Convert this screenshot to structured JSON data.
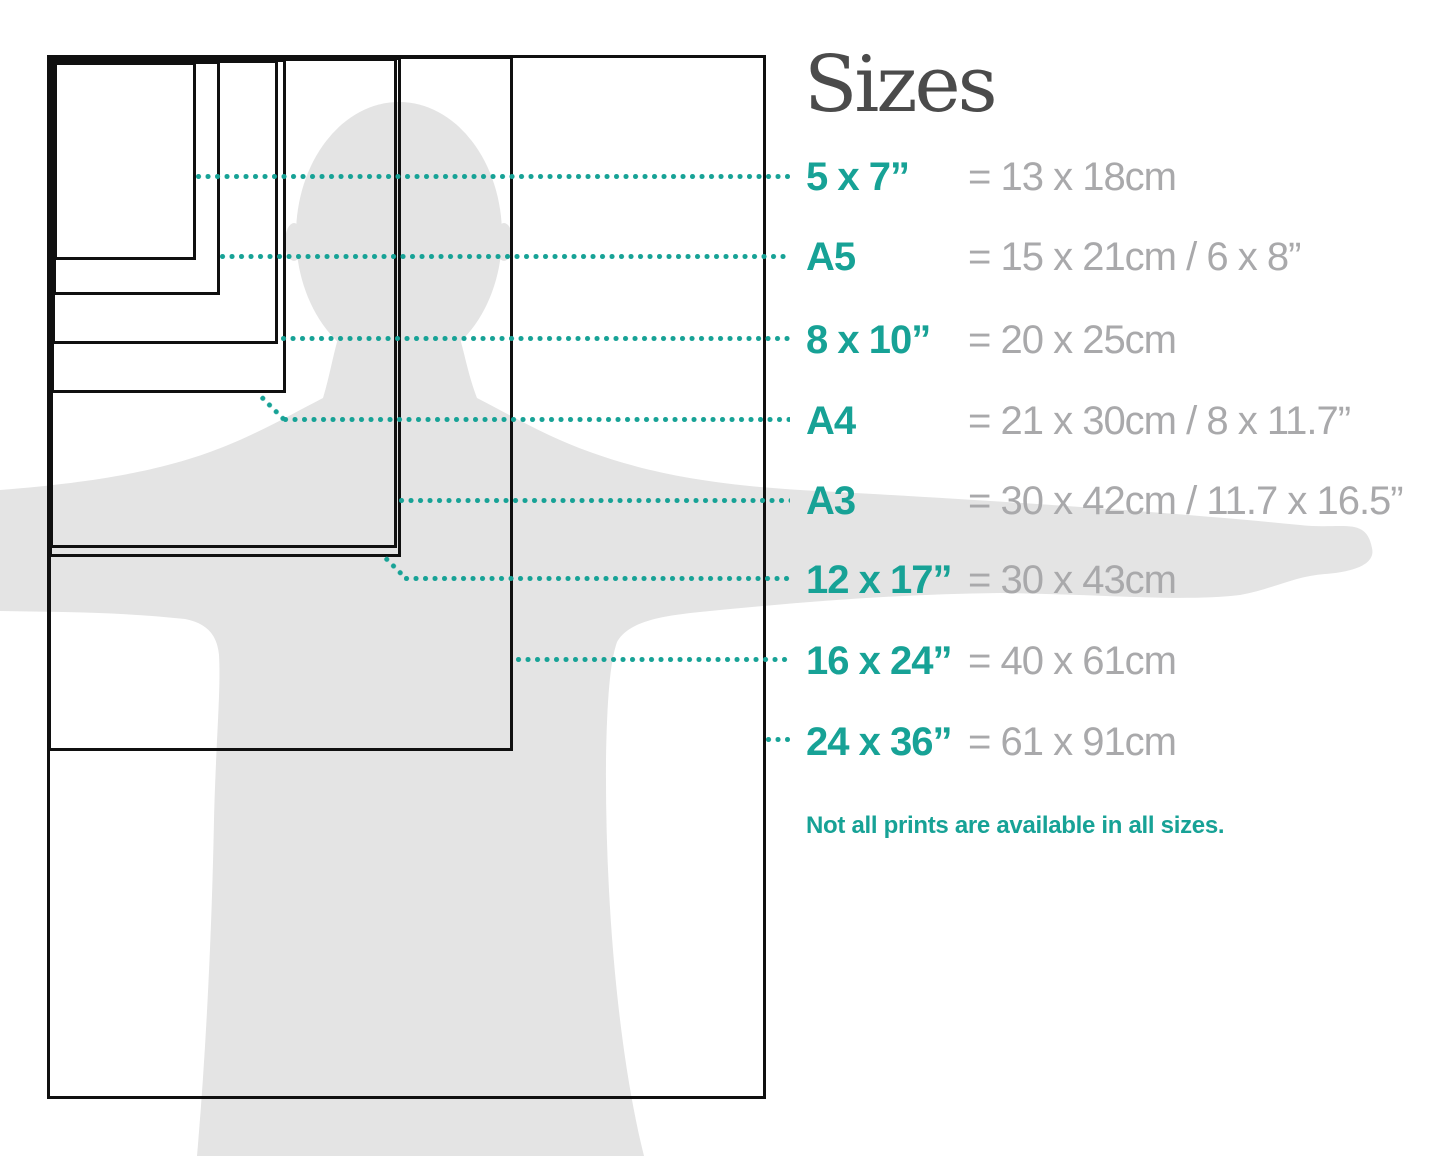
{
  "title": "Sizes",
  "note": "Not all prints are available in all sizes.",
  "rows": [
    {
      "id": "5x7",
      "label": "5 x 7”",
      "metric": "= 13 x 18cm"
    },
    {
      "id": "a5",
      "label": "A5",
      "metric": "= 15 x 21cm / 6 x 8”"
    },
    {
      "id": "8x10",
      "label": "8 x 10”",
      "metric": "= 20 x 25cm"
    },
    {
      "id": "a4",
      "label": "A4",
      "metric": "= 21 x 30cm / 8 x 11.7”"
    },
    {
      "id": "a3",
      "label": "A3",
      "metric": "= 30 x 42cm / 11.7 x 16.5”"
    },
    {
      "id": "12x17",
      "label": "12 x 17”",
      "metric": "= 30 x 43cm"
    },
    {
      "id": "16x24",
      "label": "16 x 24”",
      "metric": "= 40 x 61cm"
    },
    {
      "id": "24x36",
      "label": "24 x 36”",
      "metric": "= 61 x 91cm"
    }
  ],
  "colors": {
    "accent": "#17a296",
    "title": "#4b4b4b",
    "metric": "#a9a9ab",
    "silhouette": "#e4e4e4",
    "outline": "#101010",
    "background": "#ffffff"
  }
}
